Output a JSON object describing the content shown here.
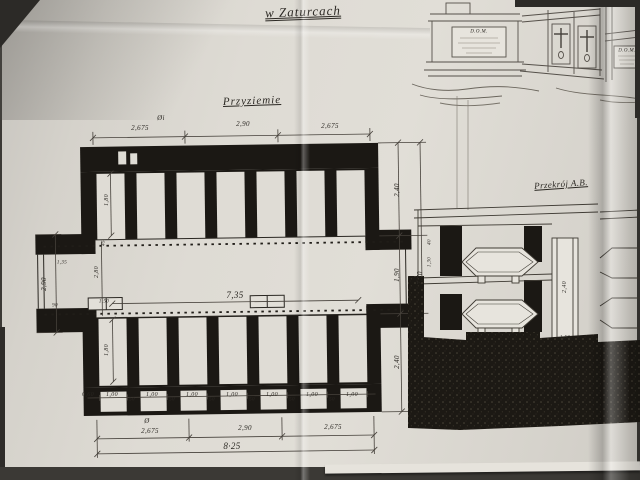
{
  "photo": {
    "paper_color": "#dcd8d1",
    "ink_color": "#1b1814",
    "pencil_color": "#55504a",
    "background_color": "#3b3935"
  },
  "title": {
    "text": "w Zaturcach"
  },
  "plan": {
    "label": "Przyziemie",
    "dims": {
      "top": [
        "2,675",
        "2,90",
        "2,675"
      ],
      "mark_top": "Øi",
      "bottom": [
        "2,675",
        "2,90",
        "2,675"
      ],
      "mark_bottom": "Ø",
      "total_width": "8·25",
      "corridor_width": "7,35",
      "corridor_depth": "2,80",
      "cell_width": "1,00",
      "pier_width": "50",
      "end_niche": "0,60",
      "cell_depth": "1,80",
      "jamb": "45",
      "left_passage": "2,90",
      "left_small": "1,35",
      "left_small_2": "90",
      "step_box": "1,50",
      "right_chain": [
        "2,40",
        "1,90",
        "2,40"
      ],
      "right_total": "7,70",
      "right_small": "1,30",
      "right_small_2": "40"
    }
  },
  "section": {
    "label": "Przekrój A.B.",
    "pillar": "2,40",
    "base": "1,50"
  },
  "elevation": {
    "plaque_left": "D.O.M.",
    "plaque_right": "D.O.M."
  }
}
